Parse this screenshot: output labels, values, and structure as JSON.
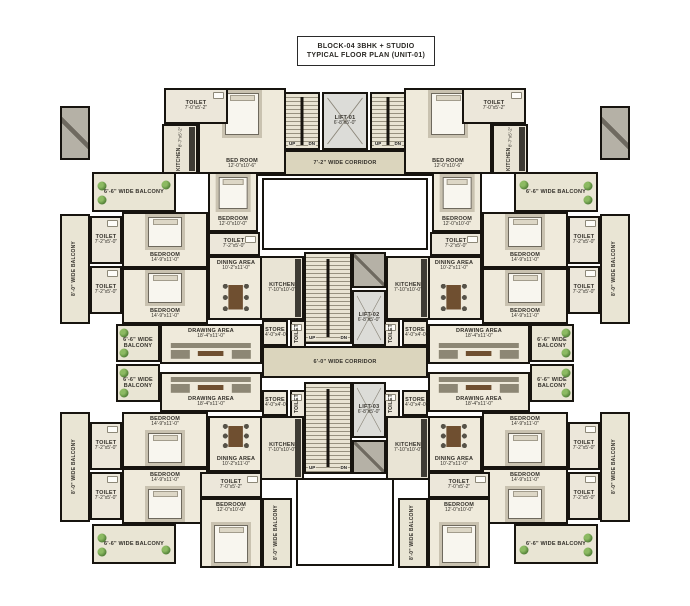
{
  "title": {
    "line1": "BLOCK-04 3BHK + STUDIO",
    "line2": "TYPICAL FLOOR PLAN (UNIT-01)"
  },
  "colors": {
    "wall": "#17140f",
    "roomfill": "#efeadb",
    "corridorfill": "#dbd5bd",
    "balconyfill": "#e9e5d4",
    "stairfill": "#e9e4d3",
    "liftfill": "#dcdcd8",
    "shaftfill": "#b5b1a6",
    "text": "#33302a",
    "plant1": "#8cba62",
    "plant2": "#4c7a33",
    "wood": "#6f4f30",
    "sofa": "#8d8775",
    "bedfill": "#f8f6ef",
    "rug": "#c9c2b0"
  },
  "plan": {
    "stair_labels": {
      "up": "UP",
      "dn": "DN"
    },
    "rooms": [
      {
        "name": "corridor-top",
        "type": "corridor",
        "label": "7'-2\" WIDE CORRIDOR",
        "dims": "",
        "x": 228,
        "y": 150,
        "w": 234,
        "h": 26,
        "lp": "c"
      },
      {
        "name": "corridor-center",
        "type": "corridor",
        "label": "6'-0\" WIDE CORRIDOR",
        "dims": "",
        "x": 262,
        "y": 346,
        "w": 166,
        "h": 32,
        "lp": "c"
      },
      {
        "name": "void-courtyard",
        "type": "void",
        "x": 262,
        "y": 178,
        "w": 166,
        "h": 72
      },
      {
        "name": "void-bottom",
        "type": "void",
        "x": 296,
        "y": 478,
        "w": 98,
        "h": 88
      },
      {
        "name": "duct-left",
        "type": "shaft",
        "x": 60,
        "y": 106,
        "w": 30,
        "h": 54
      },
      {
        "name": "duct-right",
        "type": "shaft",
        "x": 600,
        "y": 106,
        "w": 30,
        "h": 54
      },
      {
        "name": "studio-tl-bedroom",
        "type": "room",
        "label": "BED ROOM",
        "dims": "12'-0\"x10'-6\"",
        "x": 198,
        "y": 88,
        "w": 88,
        "h": 86,
        "furniture": "bed",
        "lp": "b"
      },
      {
        "name": "studio-tl-toilet",
        "type": "toilet",
        "label": "TOILET",
        "dims": "7'-0\"x5'-2\"",
        "x": 164,
        "y": 88,
        "w": 64,
        "h": 36,
        "z": 2,
        "lp": "c"
      },
      {
        "name": "studio-tl-kitchen",
        "type": "kitchen",
        "label": "KITCHEN",
        "dims": "8'-7\"x5'-2\"",
        "x": 162,
        "y": 124,
        "w": 36,
        "h": 50,
        "vert": true
      },
      {
        "name": "studio-tr-bedroom",
        "type": "room",
        "label": "BED ROOM",
        "dims": "12'-0\"x10'-6\"",
        "x": 404,
        "y": 88,
        "w": 88,
        "h": 86,
        "furniture": "bed",
        "lp": "b"
      },
      {
        "name": "studio-tr-toilet",
        "type": "toilet",
        "label": "TOILET",
        "dims": "7'-0\"x5'-2\"",
        "x": 462,
        "y": 88,
        "w": 64,
        "h": 36,
        "z": 2,
        "lp": "c"
      },
      {
        "name": "studio-tr-kitchen",
        "type": "kitchen",
        "label": "KITCHEN",
        "dims": "8'-7\"x5'-2\"",
        "x": 492,
        "y": 124,
        "w": 36,
        "h": 50,
        "vert": true
      },
      {
        "name": "stair-top-left",
        "type": "stair",
        "x": 284,
        "y": 92,
        "w": 36,
        "h": 58
      },
      {
        "name": "lift-top",
        "type": "lift",
        "label": "LIFT-01",
        "dims": "6'-8\"x5'-0\"",
        "x": 322,
        "y": 92,
        "w": 46,
        "h": 58,
        "lp": "c"
      },
      {
        "name": "stair-top-right",
        "type": "stair",
        "x": 370,
        "y": 92,
        "w": 36,
        "h": 58
      },
      {
        "name": "shaft-mid-top",
        "type": "shaft",
        "x": 352,
        "y": 252,
        "w": 34,
        "h": 36
      },
      {
        "name": "stair-mid-top",
        "type": "stair",
        "x": 304,
        "y": 252,
        "w": 48,
        "h": 92
      },
      {
        "name": "lift-mid",
        "type": "lift",
        "label": "LIFT-02",
        "dims": "6'-8\"x5'-0\"",
        "x": 352,
        "y": 290,
        "w": 34,
        "h": 56,
        "lp": "c"
      },
      {
        "name": "stair-mid-bottom",
        "type": "stair",
        "x": 304,
        "y": 382,
        "w": 48,
        "h": 92
      },
      {
        "name": "lift-bottom",
        "type": "lift",
        "label": "LIFT-03",
        "dims": "6'-8\"x5'-0\"",
        "x": 352,
        "y": 382,
        "w": 34,
        "h": 56,
        "lp": "c"
      },
      {
        "name": "shaft-mid-bottom",
        "type": "shaft",
        "x": 352,
        "y": 440,
        "w": 34,
        "h": 34
      },
      {
        "name": "ul-balcony-corner",
        "type": "balcony",
        "label": "6'-6\" WIDE BALCONY",
        "dims": "",
        "x": 92,
        "y": 172,
        "w": 84,
        "h": 40,
        "lp": "c",
        "plants": [
          [
            10,
            32
          ],
          [
            10,
            72
          ],
          [
            90,
            30
          ]
        ]
      },
      {
        "name": "ul-balcony-edge",
        "type": "balcony",
        "label": "8'-0\" WIDE BALCONY",
        "dims": "",
        "x": 60,
        "y": 214,
        "w": 30,
        "h": 110,
        "vert": true
      },
      {
        "name": "ul-toilet-a",
        "type": "toilet",
        "label": "TOILET",
        "dims": "7'-2\"x5'-0\"",
        "x": 90,
        "y": 216,
        "w": 32,
        "h": 48,
        "lp": "c"
      },
      {
        "name": "ul-toilet-b",
        "type": "toilet",
        "label": "TOILET",
        "dims": "7'-2\"x5'-0\"",
        "x": 90,
        "y": 266,
        "w": 32,
        "h": 48,
        "lp": "c"
      },
      {
        "name": "ul-bedroom-1",
        "type": "room",
        "label": "BEDROOM",
        "dims": "14'-9\"x11'-0\"",
        "x": 122,
        "y": 212,
        "w": 86,
        "h": 56,
        "furniture": "bed",
        "lp": "b"
      },
      {
        "name": "ul-bedroom-2",
        "type": "room",
        "label": "BEDROOM",
        "dims": "14'-9\"x11'-0\"",
        "x": 122,
        "y": 268,
        "w": 86,
        "h": 56,
        "furniture": "bed",
        "lp": "b"
      },
      {
        "name": "ul-bedroom-3",
        "type": "room",
        "label": "BEDROOM",
        "dims": "12'-0\"x10'-0\"",
        "x": 208,
        "y": 172,
        "w": 50,
        "h": 60,
        "furniture": "bed",
        "lp": "b"
      },
      {
        "name": "ul-toilet-c",
        "type": "toilet",
        "label": "TOILET",
        "dims": "7'-2\"x5'-0\"",
        "x": 208,
        "y": 232,
        "w": 52,
        "h": 24,
        "lp": "c"
      },
      {
        "name": "ul-dining",
        "type": "room",
        "label": "DINING AREA",
        "dims": "10'-2\"x11'-0\"",
        "x": 208,
        "y": 256,
        "w": 56,
        "h": 64,
        "furniture": "dining",
        "lp": "t"
      },
      {
        "name": "ul-kitchen",
        "type": "kitchen",
        "label": "KITCHEN",
        "dims": "7'-10\"x10'-0\"",
        "x": 260,
        "y": 256,
        "w": 44,
        "h": 64,
        "lp": "c"
      },
      {
        "name": "ul-drawing",
        "type": "room",
        "label": "DRAWING AREA",
        "dims": "18'-4\"x11'-0\"",
        "x": 160,
        "y": 324,
        "w": 102,
        "h": 40,
        "furniture": "sofa",
        "lp": "t"
      },
      {
        "name": "ul-store",
        "type": "store",
        "label": "STORE",
        "dims": "4'-0\"x4'-0\"",
        "x": 262,
        "y": 320,
        "w": 26,
        "h": 26,
        "lp": "c"
      },
      {
        "name": "ul-wc",
        "type": "toilet",
        "label": "TOILET",
        "dims": "",
        "x": 290,
        "y": 320,
        "w": 16,
        "h": 28,
        "vert": true
      },
      {
        "name": "balcony-mid-left-up",
        "type": "balcony",
        "label": "6'-6\" WIDE BALCONY",
        "dims": "",
        "x": 116,
        "y": 324,
        "w": 44,
        "h": 38,
        "lp": "c",
        "plants": [
          [
            16,
            20
          ],
          [
            16,
            80
          ]
        ]
      },
      {
        "name": "balcony-mid-left-dn",
        "type": "balcony",
        "label": "6'-6\" WIDE BALCONY",
        "dims": "",
        "x": 116,
        "y": 364,
        "w": 44,
        "h": 38,
        "lp": "c",
        "plants": [
          [
            16,
            20
          ],
          [
            16,
            80
          ]
        ]
      },
      {
        "name": "ur-balcony-corner",
        "type": "balcony",
        "label": "6'-6\" WIDE BALCONY",
        "dims": "",
        "x": 514,
        "y": 172,
        "w": 84,
        "h": 40,
        "lp": "c",
        "plants": [
          [
            90,
            32
          ],
          [
            90,
            72
          ],
          [
            10,
            30
          ]
        ]
      },
      {
        "name": "ur-balcony-edge",
        "type": "balcony",
        "label": "8'-0\" WIDE BALCONY",
        "dims": "",
        "x": 600,
        "y": 214,
        "w": 30,
        "h": 110,
        "vert": true
      },
      {
        "name": "ur-toilet-a",
        "type": "toilet",
        "label": "TOILET",
        "dims": "7'-2\"x5'-0\"",
        "x": 568,
        "y": 216,
        "w": 32,
        "h": 48,
        "lp": "c"
      },
      {
        "name": "ur-toilet-b",
        "type": "toilet",
        "label": "TOILET",
        "dims": "7'-2\"x5'-0\"",
        "x": 568,
        "y": 266,
        "w": 32,
        "h": 48,
        "lp": "c"
      },
      {
        "name": "ur-bedroom-1",
        "type": "room",
        "label": "BEDROOM",
        "dims": "14'-9\"x11'-0\"",
        "x": 482,
        "y": 212,
        "w": 86,
        "h": 56,
        "furniture": "bed",
        "lp": "b"
      },
      {
        "name": "ur-bedroom-2",
        "type": "room",
        "label": "BEDROOM",
        "dims": "14'-9\"x11'-0\"",
        "x": 482,
        "y": 268,
        "w": 86,
        "h": 56,
        "furniture": "bed",
        "lp": "b"
      },
      {
        "name": "ur-bedroom-3",
        "type": "room",
        "label": "BEDROOM",
        "dims": "12'-0\"x10'-0\"",
        "x": 432,
        "y": 172,
        "w": 50,
        "h": 60,
        "furniture": "bed",
        "lp": "b"
      },
      {
        "name": "ur-toilet-c",
        "type": "toilet",
        "label": "TOILET",
        "dims": "7'-2\"x5'-0\"",
        "x": 430,
        "y": 232,
        "w": 52,
        "h": 24,
        "lp": "c"
      },
      {
        "name": "ur-dining",
        "type": "room",
        "label": "DINING AREA",
        "dims": "10'-2\"x11'-0\"",
        "x": 426,
        "y": 256,
        "w": 56,
        "h": 64,
        "furniture": "dining",
        "lp": "t"
      },
      {
        "name": "ur-kitchen",
        "type": "kitchen",
        "label": "KITCHEN",
        "dims": "7'-10\"x10'-0\"",
        "x": 386,
        "y": 256,
        "w": 44,
        "h": 64,
        "lp": "c"
      },
      {
        "name": "ur-drawing",
        "type": "room",
        "label": "DRAWING AREA",
        "dims": "18'-4\"x11'-0\"",
        "x": 428,
        "y": 324,
        "w": 102,
        "h": 40,
        "furniture": "sofa",
        "lp": "t"
      },
      {
        "name": "ur-store",
        "type": "store",
        "label": "STORE",
        "dims": "4'-0\"x4'-0\"",
        "x": 402,
        "y": 320,
        "w": 26,
        "h": 26,
        "lp": "c"
      },
      {
        "name": "ur-wc",
        "type": "toilet",
        "label": "TOILET",
        "dims": "",
        "x": 384,
        "y": 320,
        "w": 16,
        "h": 28,
        "vert": true
      },
      {
        "name": "balcony-mid-right-up",
        "type": "balcony",
        "label": "6'-6\" WIDE BALCONY",
        "dims": "",
        "x": 530,
        "y": 324,
        "w": 44,
        "h": 38,
        "lp": "c",
        "plants": [
          [
            84,
            20
          ],
          [
            84,
            80
          ]
        ]
      },
      {
        "name": "balcony-mid-right-dn",
        "type": "balcony",
        "label": "6'-6\" WIDE BALCONY",
        "dims": "",
        "x": 530,
        "y": 364,
        "w": 44,
        "h": 38,
        "lp": "c",
        "plants": [
          [
            84,
            20
          ],
          [
            84,
            80
          ]
        ]
      },
      {
        "name": "ll-drawing",
        "type": "room",
        "label": "DRAWING AREA",
        "dims": "18'-4\"x11'-0\"",
        "x": 160,
        "y": 372,
        "w": 102,
        "h": 40,
        "furniture": "sofa",
        "lp": "b"
      },
      {
        "name": "ll-store",
        "type": "store",
        "label": "STORE",
        "dims": "4'-0\"x4'-0\"",
        "x": 262,
        "y": 390,
        "w": 26,
        "h": 26,
        "lp": "c"
      },
      {
        "name": "ll-wc",
        "type": "toilet",
        "label": "TOILET",
        "dims": "",
        "x": 290,
        "y": 390,
        "w": 16,
        "h": 28,
        "vert": true
      },
      {
        "name": "ll-dining",
        "type": "room",
        "label": "DINING AREA",
        "dims": "10'-2\"x11'-0\"",
        "x": 208,
        "y": 416,
        "w": 56,
        "h": 56,
        "furniture": "dining",
        "lp": "b"
      },
      {
        "name": "ll-kitchen",
        "type": "kitchen",
        "label": "KITCHEN",
        "dims": "7'-10\"x10'-0\"",
        "x": 260,
        "y": 416,
        "w": 44,
        "h": 64,
        "lp": "c"
      },
      {
        "name": "ll-bedroom-2",
        "type": "room",
        "label": "BEDROOM",
        "dims": "14'-9\"x11'-0\"",
        "x": 122,
        "y": 412,
        "w": 86,
        "h": 56,
        "furniture": "bed",
        "lp": "t"
      },
      {
        "name": "ll-bedroom-1",
        "type": "room",
        "label": "BEDROOM",
        "dims": "14'-9\"x11'-0\"",
        "x": 122,
        "y": 468,
        "w": 86,
        "h": 56,
        "furniture": "bed",
        "lp": "t"
      },
      {
        "name": "ll-toilet-b",
        "type": "toilet",
        "label": "TOILET",
        "dims": "7'-2\"x5'-0\"",
        "x": 90,
        "y": 422,
        "w": 32,
        "h": 48,
        "lp": "c"
      },
      {
        "name": "ll-toilet-a",
        "type": "toilet",
        "label": "TOILET",
        "dims": "7'-2\"x5'-0\"",
        "x": 90,
        "y": 472,
        "w": 32,
        "h": 48,
        "lp": "c"
      },
      {
        "name": "ll-balcony-edge",
        "type": "balcony",
        "label": "8'-0\" WIDE BALCONY",
        "dims": "",
        "x": 60,
        "y": 412,
        "w": 30,
        "h": 110,
        "vert": true
      },
      {
        "name": "ll-balcony-corner",
        "type": "balcony",
        "label": "6'-6\" WIDE BALCONY",
        "dims": "",
        "x": 92,
        "y": 524,
        "w": 84,
        "h": 40,
        "lp": "c",
        "plants": [
          [
            10,
            32
          ],
          [
            10,
            72
          ],
          [
            90,
            68
          ]
        ]
      },
      {
        "name": "studio-bl-toilet",
        "type": "toilet",
        "label": "TOILET",
        "dims": "7'-0\"x5'-2\"",
        "x": 200,
        "y": 472,
        "w": 62,
        "h": 26,
        "lp": "c"
      },
      {
        "name": "studio-bl-bedroom",
        "type": "room",
        "label": "BEDROOM",
        "dims": "12'-0\"x10'-0\"",
        "x": 200,
        "y": 498,
        "w": 62,
        "h": 70,
        "furniture": "bed",
        "lp": "t"
      },
      {
        "name": "studio-bl-balcony",
        "type": "balcony",
        "label": "8'-0\" WIDE BALCONY",
        "dims": "",
        "x": 262,
        "y": 498,
        "w": 30,
        "h": 70,
        "vert": true
      },
      {
        "name": "lr-drawing",
        "type": "room",
        "label": "DRAWING AREA",
        "dims": "18'-4\"x11'-0\"",
        "x": 428,
        "y": 372,
        "w": 102,
        "h": 40,
        "furniture": "sofa",
        "lp": "b"
      },
      {
        "name": "lr-store",
        "type": "store",
        "label": "STORE",
        "dims": "4'-0\"x4'-0\"",
        "x": 402,
        "y": 390,
        "w": 26,
        "h": 26,
        "lp": "c"
      },
      {
        "name": "lr-wc",
        "type": "toilet",
        "label": "TOILET",
        "dims": "",
        "x": 384,
        "y": 390,
        "w": 16,
        "h": 28,
        "vert": true
      },
      {
        "name": "lr-dining",
        "type": "room",
        "label": "DINING AREA",
        "dims": "10'-2\"x11'-0\"",
        "x": 426,
        "y": 416,
        "w": 56,
        "h": 56,
        "furniture": "dining",
        "lp": "b"
      },
      {
        "name": "lr-kitchen",
        "type": "kitchen",
        "label": "KITCHEN",
        "dims": "7'-10\"x10'-0\"",
        "x": 386,
        "y": 416,
        "w": 44,
        "h": 64,
        "lp": "c"
      },
      {
        "name": "lr-bedroom-2",
        "type": "room",
        "label": "BEDROOM",
        "dims": "14'-9\"x11'-0\"",
        "x": 482,
        "y": 412,
        "w": 86,
        "h": 56,
        "furniture": "bed",
        "lp": "t"
      },
      {
        "name": "lr-bedroom-1",
        "type": "room",
        "label": "BEDROOM",
        "dims": "14'-9\"x11'-0\"",
        "x": 482,
        "y": 468,
        "w": 86,
        "h": 56,
        "furniture": "bed",
        "lp": "t"
      },
      {
        "name": "lr-toilet-b",
        "type": "toilet",
        "label": "TOILET",
        "dims": "7'-2\"x5'-0\"",
        "x": 568,
        "y": 422,
        "w": 32,
        "h": 48,
        "lp": "c"
      },
      {
        "name": "lr-toilet-a",
        "type": "toilet",
        "label": "TOILET",
        "dims": "7'-2\"x5'-0\"",
        "x": 568,
        "y": 472,
        "w": 32,
        "h": 48,
        "lp": "c"
      },
      {
        "name": "lr-balcony-edge",
        "type": "balcony",
        "label": "8'-0\" WIDE BALCONY",
        "dims": "",
        "x": 600,
        "y": 412,
        "w": 30,
        "h": 110,
        "vert": true
      },
      {
        "name": "lr-balcony-corner",
        "type": "balcony",
        "label": "6'-6\" WIDE BALCONY",
        "dims": "",
        "x": 514,
        "y": 524,
        "w": 84,
        "h": 40,
        "lp": "c",
        "plants": [
          [
            90,
            32
          ],
          [
            90,
            72
          ],
          [
            10,
            68
          ]
        ]
      },
      {
        "name": "studio-br-toilet",
        "type": "toilet",
        "label": "TOILET",
        "dims": "7'-0\"x5'-2\"",
        "x": 428,
        "y": 472,
        "w": 62,
        "h": 26,
        "lp": "c"
      },
      {
        "name": "studio-br-bedroom",
        "type": "room",
        "label": "BEDROOM",
        "dims": "12'-0\"x10'-0\"",
        "x": 428,
        "y": 498,
        "w": 62,
        "h": 70,
        "furniture": "bed",
        "lp": "t"
      },
      {
        "name": "studio-br-balcony",
        "type": "balcony",
        "label": "8'-0\" WIDE BALCONY",
        "dims": "",
        "x": 398,
        "y": 498,
        "w": 30,
        "h": 70,
        "vert": true
      }
    ]
  }
}
